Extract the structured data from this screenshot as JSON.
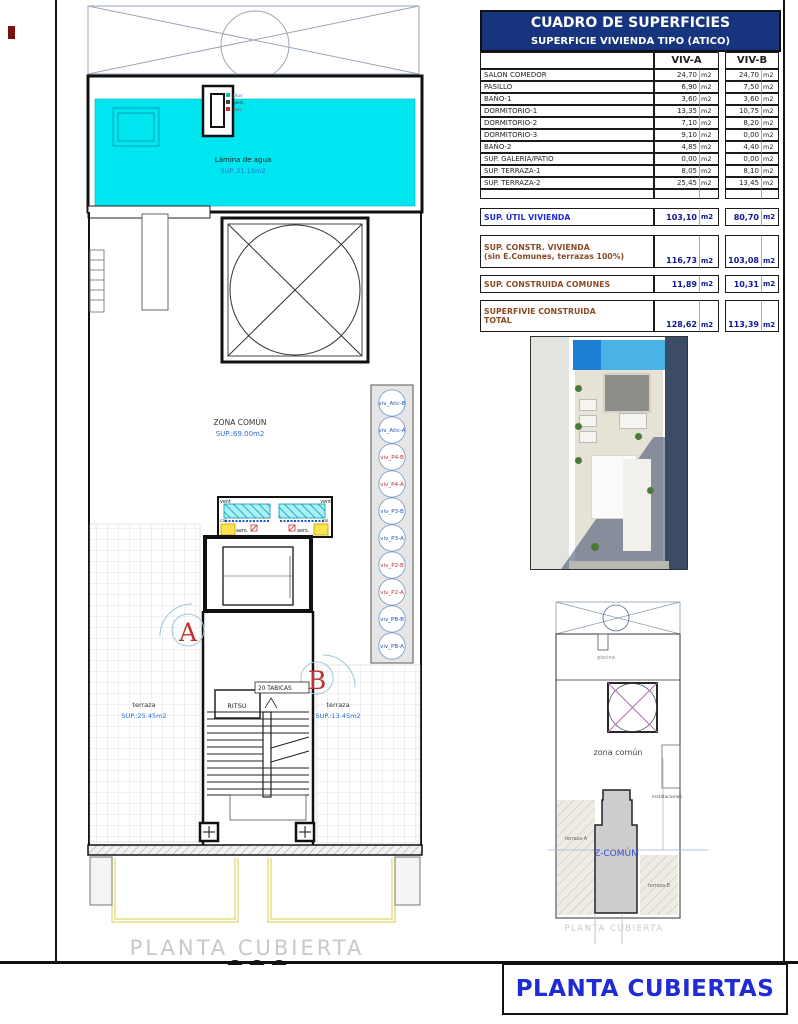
{
  "colors": {
    "pool_water": "#00E6F0",
    "header_blue": "#17357E",
    "accent_blue": "#1f2bd4",
    "label_blue": "#2a6fd6",
    "label_red": "#c03030",
    "brown": "#8a4a22",
    "summary_navy": "#101694",
    "riser_blue": "#2255bb",
    "riser_red": "#c03030"
  },
  "table": {
    "title": "CUADRO DE SUPERFICIES",
    "subtitle": "SUPERFICIE VIVIENDA TIPO  (ATICO)",
    "col_a": "VIV-A",
    "col_b": "VIV-B",
    "unit": "m2",
    "rows": [
      {
        "label": "SALON COMEDOR",
        "a": "24,70",
        "b": "24,70"
      },
      {
        "label": "PASILLO",
        "a": "6,90",
        "b": "7,50"
      },
      {
        "label": "BAÑO-1",
        "a": "3,60",
        "b": "3,60"
      },
      {
        "label": "DORMITORIO-1",
        "a": "13,35",
        "b": "10,75"
      },
      {
        "label": "DORMITORIO-2",
        "a": "7,10",
        "b": "8,20"
      },
      {
        "label": "DORMITORIO-3",
        "a": "9,10",
        "b": "0,00"
      },
      {
        "label": "BAÑO-2",
        "a": "4,85",
        "b": "4,40"
      },
      {
        "label": "SUP. GALERIA/PATIO",
        "a": "0,00",
        "b": "0,00"
      },
      {
        "label": "SUP. TERRAZA-1",
        "a": "8,05",
        "b": "8,10"
      },
      {
        "label": "SUP. TERRAZA-2",
        "a": "25,45",
        "b": "13,45"
      }
    ],
    "summary": [
      {
        "label1": "SUP. ÚTIL VIVIENDA",
        "label2": "",
        "a": "103,10",
        "b": "80,70"
      },
      {
        "label1": "SUP. CONSTR. VIVIENDA",
        "label2": "(sin E.Comunes, terrazas 100%)",
        "a": "116,73",
        "b": "103,08"
      },
      {
        "label1": "SUP. CONSTRUIDA COMUNES",
        "label2": "",
        "a": "11,89",
        "b": "10,31"
      },
      {
        "label1": "SUPERFIVIE CONSTRUIDA",
        "label2": "TOTAL",
        "a": "128,62",
        "b": "113,39"
      }
    ]
  },
  "plan": {
    "pool_label": "Lámina de agua",
    "pool_area": "SUP. 21.15m2",
    "shaft_labels": [
      "pluv",
      "vent.",
      "san."
    ],
    "zona_comun": "ZONA COMÚN",
    "zona_comun_area": "SUP.:69.00m2",
    "risers": [
      {
        "label": "viv_Atic-B",
        "color": "blue"
      },
      {
        "label": "viv_Atic-A",
        "color": "blue"
      },
      {
        "label": "viv_P4-B",
        "color": "red"
      },
      {
        "label": "viv_P4-A",
        "color": "red"
      },
      {
        "label": "viv_P3-B",
        "color": "blue"
      },
      {
        "label": "viv_P3-A",
        "color": "blue"
      },
      {
        "label": "viv_P2-B",
        "color": "red"
      },
      {
        "label": "viv_P2-A",
        "color": "red"
      },
      {
        "label": "viv_PB-B",
        "color": "blue"
      },
      {
        "label": "viv_PB-A",
        "color": "blue"
      }
    ],
    "machinery": {
      "vent_left": "vent",
      "vent_right": "vent",
      "cal_left": "cal.",
      "aero_left": "aero.",
      "aero_right": "aero.",
      "cal_right": "cal.",
      "san": "san."
    },
    "letter_a": "A",
    "letter_b": "B",
    "terraza_left": {
      "name": "terraza",
      "area": "SUP.:25.45m2"
    },
    "terraza_right": {
      "name": "terraza",
      "area": "SUP.:13.45m2"
    },
    "ritsu": "RITSU",
    "tabicas": "20 TABICAS",
    "caption": "PLANTA CUBIERTA"
  },
  "mini": {
    "piscina": "piscina",
    "zona_comun": "zona común",
    "z_comun": "Z-COMÚN",
    "instalaciones": "instalaciones",
    "terraza_a": "terraza-A",
    "terraza_b": "terraza-B",
    "caption": "PLANTA CUBIERTA"
  },
  "title_block": {
    "title": "PLANTA CUBIERTAS"
  }
}
